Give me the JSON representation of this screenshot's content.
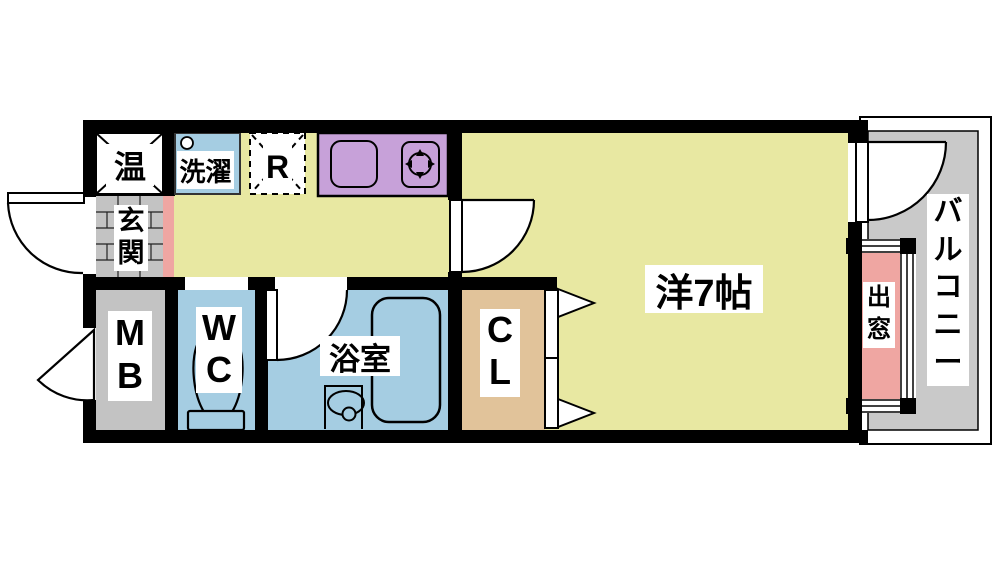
{
  "floorplan": {
    "rooms": {
      "water_heater": "温",
      "laundry": "洗濯",
      "refrigerator": "R",
      "entrance": "玄関",
      "meter_box": "MB",
      "toilet": "WC",
      "bathroom": "浴室",
      "closet": "CL",
      "main_room": "洋7帖",
      "bay_window": "出窓",
      "balcony": "バルコニー"
    },
    "colors": {
      "wall": "#000000",
      "floor": "#e8e8a2",
      "kitchen_counter": "#c7a1d9",
      "wet_area": "#a5cde2",
      "gray_area": "#c3c3c3",
      "balcony_floor": "#c9c9c9",
      "bay_window": "#efa6a2",
      "entrance_step": "#efa6a2",
      "closet": "#e1c39a",
      "label_bg": "#ffffff"
    }
  }
}
